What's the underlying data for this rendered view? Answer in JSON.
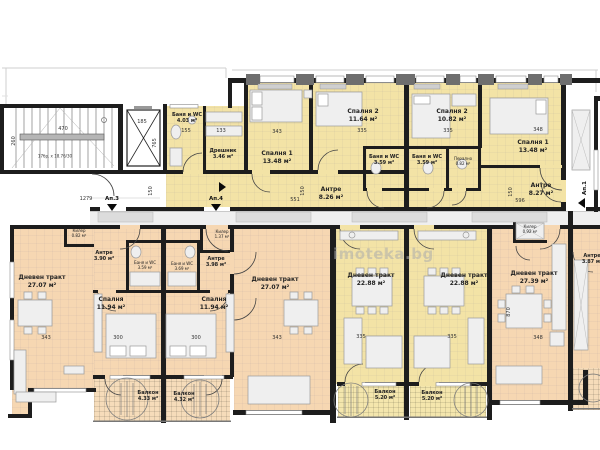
{
  "watermark": "imoteka.bg",
  "stair_note": "17бр. x 18.76/30",
  "apartment_markers": {
    "ap1": "Ап.1",
    "ap3": "Ап.3",
    "ap4": "Ап.4"
  },
  "colors": {
    "yellow_room": "#f3e3a6",
    "orange_room": "#f6d7b2",
    "wall": "#1d1d1d"
  },
  "rooms": {
    "bath403": {
      "name": "Баня и WC",
      "area": "4.03 м²"
    },
    "dressing": {
      "name": "Дрешник",
      "area": "3.46 м²"
    },
    "bedroom1_left": {
      "name": "Спалня 1",
      "area": "13.48 м²"
    },
    "bedroom2_left": {
      "name": "Спалня 2",
      "area": "11.64 м²"
    },
    "bath_mid_left": {
      "name": "Баня и WC",
      "area": "3.59 м²"
    },
    "bath_mid_right": {
      "name": "Баня и WC",
      "area": "3.59 м²"
    },
    "laundry": {
      "name": "Перално",
      "area": "0.82 м²"
    },
    "bedroom2_right": {
      "name": "Спалня 2",
      "area": "10.82 м²"
    },
    "bedroom1_right": {
      "name": "Спалня 1",
      "area": "13.48 м²"
    },
    "antre_left": {
      "name": "Антре",
      "area": "8.26 м²"
    },
    "antre_right": {
      "name": "Антре",
      "area": "8.27 м²"
    },
    "kiler_a": {
      "name": "Килер",
      "area": "0.82 м²"
    },
    "living_a": {
      "name": "Дневен тракт",
      "area": "27.07 м²"
    },
    "antre_a": {
      "name": "Антре",
      "area": "3.90 м²"
    },
    "bath_a": {
      "name": "Баня и WC",
      "area": "3.59 м²"
    },
    "bedroom_a": {
      "name": "Спалня",
      "area": "11.94 м²"
    },
    "balcony_a": {
      "name": "Балкон",
      "area": "4.33 м²"
    },
    "kiler_b": {
      "name": "Килер",
      "area": "1.37 м²"
    },
    "antre_b": {
      "name": "Антре",
      "area": "3.98 м²"
    },
    "bath_b": {
      "name": "Баня и WC",
      "area": "3.69 м²"
    },
    "bedroom_b": {
      "name": "Спалня",
      "area": "11.94 м²"
    },
    "living_b": {
      "name": "Дневен тракт",
      "area": "27.07 м²"
    },
    "balcony_b": {
      "name": "Балкон",
      "area": "4.32 м²"
    },
    "living_c": {
      "name": "Дневен тракт",
      "area": "22.88 м²"
    },
    "balcony_c": {
      "name": "Балкон",
      "area": "5.20 м²"
    },
    "living_d": {
      "name": "Дневен тракт",
      "area": "22.88 м²"
    },
    "balcony_d": {
      "name": "Балкон",
      "area": "5.20 м²"
    },
    "living_e": {
      "name": "Дневен тракт",
      "area": "27.39 м²"
    },
    "kiler_e": {
      "name": "Килер",
      "area": "0.92 м²"
    },
    "antre_e": {
      "name": "Антре",
      "area": "3.87 м²"
    }
  },
  "dimensions": {
    "d470": "470",
    "d260": "260",
    "d1279": "1279",
    "d185": "185",
    "d765": "765",
    "d155": "155",
    "d133": "133",
    "d343_top": "343",
    "d335_top": "335",
    "d335_top2": "335",
    "d348_top": "348",
    "d596": "596",
    "d551": "551",
    "d150a": "150",
    "d150b": "150",
    "d150c": "150",
    "d343_a": "343",
    "d343_b": "343",
    "d300_a": "300",
    "d300_b": "300",
    "d335_c": "335",
    "d335_d": "335",
    "d348_e": "348",
    "d870": "870"
  }
}
